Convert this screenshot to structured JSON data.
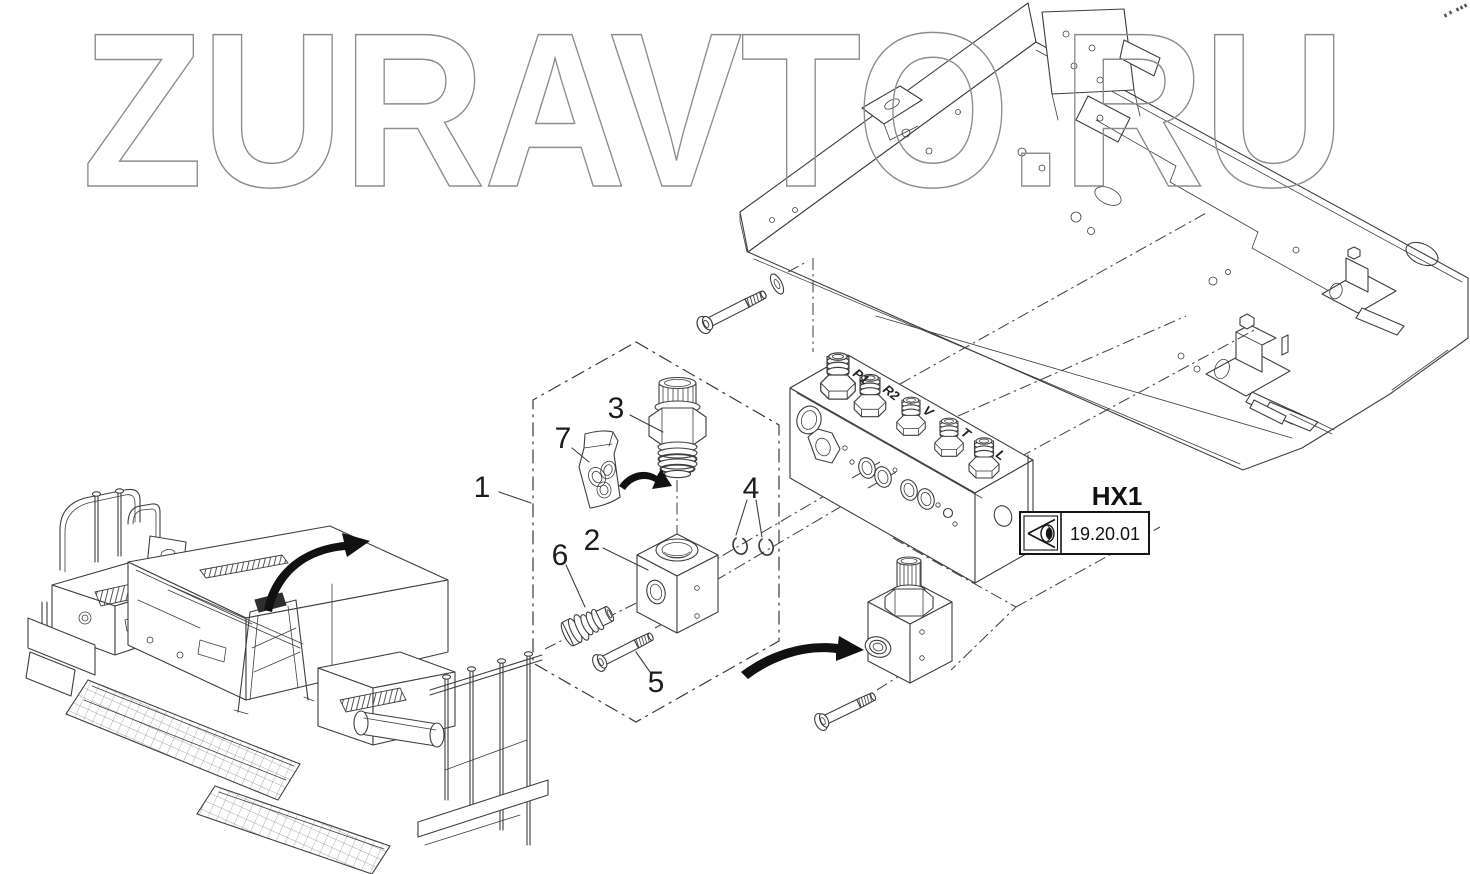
{
  "watermark": "ZURAVTO.RU",
  "callouts": [
    "1",
    "2",
    "3",
    "4",
    "5",
    "6",
    "7"
  ],
  "ports": [
    "P1",
    "R2",
    "V",
    "T",
    "L"
  ],
  "reference": {
    "code": "HX1",
    "sheet": "19.20.01",
    "icon": "eye-icon"
  },
  "colors": {
    "line": "#3e3e3e",
    "watermark_outline": "#8d8d8d",
    "arrow": "#111111",
    "text": "#1c1c1c",
    "background": "#ffffff"
  }
}
